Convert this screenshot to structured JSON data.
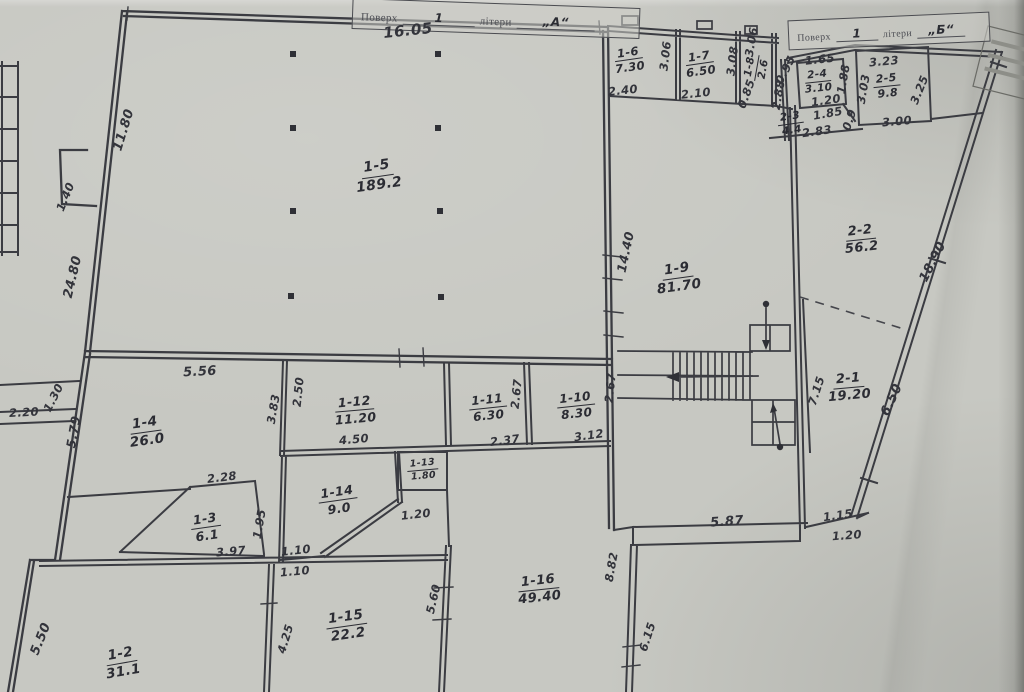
{
  "title_blocks": {
    "a": {
      "prefix": "Поверх",
      "floor": "1",
      "middle": "літери",
      "letter": "„А“"
    },
    "b": {
      "prefix": "Поверх",
      "floor": "1",
      "middle": "літери",
      "letter": "„Б“"
    }
  },
  "rooms": [
    {
      "id": "1-5",
      "a": "189.2",
      "x": 378,
      "y": 176,
      "r": -8,
      "fs": 14
    },
    {
      "id": "1-6",
      "a": "7.30",
      "x": 629,
      "y": 60,
      "r": -8,
      "fs": 11.5
    },
    {
      "id": "1-7",
      "a": "6.50",
      "x": 700,
      "y": 64,
      "r": -8,
      "fs": 11.5
    },
    {
      "id": "1-8",
      "a": "2.6",
      "x": 757,
      "y": 68,
      "r": -80,
      "fs": 10.5
    },
    {
      "id": "2-4",
      "a": "3.10",
      "x": 818,
      "y": 82,
      "r": -6,
      "fs": 10.5
    },
    {
      "id": "2-5",
      "a": "9.8",
      "x": 887,
      "y": 86,
      "r": -6,
      "fs": 11
    },
    {
      "id": "2-3",
      "a": "4.4",
      "x": 791,
      "y": 124,
      "r": -8,
      "fs": 10.5
    },
    {
      "id": "2-2",
      "a": "56.2",
      "x": 861,
      "y": 240,
      "r": -6,
      "fs": 13
    },
    {
      "id": "1-9",
      "a": "81.70",
      "x": 678,
      "y": 278,
      "r": -8,
      "fs": 13.5
    },
    {
      "id": "2-1",
      "a": "19.20",
      "x": 849,
      "y": 388,
      "r": -5,
      "fs": 13
    },
    {
      "id": "1-4",
      "a": "26.0",
      "x": 146,
      "y": 432,
      "r": -8,
      "fs": 13.5
    },
    {
      "id": "1-12",
      "a": "11.20",
      "x": 355,
      "y": 410,
      "r": -5,
      "fs": 12.5
    },
    {
      "id": "1-11",
      "a": "6.30",
      "x": 488,
      "y": 408,
      "r": -6,
      "fs": 12
    },
    {
      "id": "1-10",
      "a": "8.30",
      "x": 576,
      "y": 406,
      "r": -6,
      "fs": 12
    },
    {
      "id": "1-13",
      "a": "1.80",
      "x": 423,
      "y": 470,
      "r": -5,
      "fs": 9.5
    },
    {
      "id": "1-14",
      "a": "9.0",
      "x": 338,
      "y": 500,
      "r": -8,
      "fs": 12.5
    },
    {
      "id": "1-3",
      "a": "6.1",
      "x": 206,
      "y": 527,
      "r": -8,
      "fs": 12.5
    },
    {
      "id": "1-15",
      "a": "22.2",
      "x": 347,
      "y": 626,
      "r": -8,
      "fs": 13.5
    },
    {
      "id": "1-16",
      "a": "49.40",
      "x": 539,
      "y": 590,
      "r": -6,
      "fs": 13
    },
    {
      "id": "1-2",
      "a": "31.1",
      "x": 122,
      "y": 663,
      "r": -10,
      "fs": 13.5
    }
  ],
  "dims": [
    {
      "t": "16.05",
      "x": 408,
      "y": 31,
      "r": -6,
      "fs": 15
    },
    {
      "t": "11.80",
      "x": 124,
      "y": 130,
      "r": -73,
      "fs": 13
    },
    {
      "t": "1.40",
      "x": 66,
      "y": 197,
      "r": -68
    },
    {
      "t": "24.80",
      "x": 73,
      "y": 277,
      "r": -77,
      "fs": 13
    },
    {
      "t": "2.40",
      "x": 623,
      "y": 91,
      "r": -6
    },
    {
      "t": "3.06",
      "x": 666,
      "y": 56,
      "r": -83
    },
    {
      "t": "2.10",
      "x": 696,
      "y": 94,
      "r": -6
    },
    {
      "t": "3.08",
      "x": 733,
      "y": 61,
      "r": -83
    },
    {
      "t": "3.06",
      "x": 752,
      "y": 42,
      "r": -80
    },
    {
      "t": "0.85",
      "x": 747,
      "y": 94,
      "r": -70
    },
    {
      "t": "0.95",
      "x": 786,
      "y": 70,
      "r": -63
    },
    {
      "t": "2.88",
      "x": 779,
      "y": 95,
      "r": -80
    },
    {
      "t": "1.65",
      "x": 820,
      "y": 60,
      "r": -6
    },
    {
      "t": "1.88",
      "x": 844,
      "y": 79,
      "r": -80
    },
    {
      "t": "1.20",
      "x": 826,
      "y": 101,
      "r": -8
    },
    {
      "t": "1.85",
      "x": 828,
      "y": 114,
      "r": -10
    },
    {
      "t": "0.9",
      "x": 850,
      "y": 120,
      "r": -72
    },
    {
      "t": "2.83",
      "x": 817,
      "y": 132,
      "r": -8
    },
    {
      "t": "3.23",
      "x": 884,
      "y": 62,
      "r": -5
    },
    {
      "t": "3.03",
      "x": 864,
      "y": 89,
      "r": -80
    },
    {
      "t": "3.25",
      "x": 920,
      "y": 90,
      "r": -68
    },
    {
      "t": "3.00",
      "x": 897,
      "y": 122,
      "r": -5
    },
    {
      "t": "18.90",
      "x": 933,
      "y": 262,
      "r": -63,
      "fs": 13
    },
    {
      "t": "14.40",
      "x": 626,
      "y": 252,
      "r": -78,
      "fs": 12.5
    },
    {
      "t": "7.15",
      "x": 817,
      "y": 391,
      "r": -72
    },
    {
      "t": "6.50",
      "x": 892,
      "y": 400,
      "r": -65,
      "fs": 13
    },
    {
      "t": "5.56",
      "x": 200,
      "y": 372,
      "r": -3,
      "fs": 13
    },
    {
      "t": "3.83",
      "x": 274,
      "y": 409,
      "r": -80
    },
    {
      "t": "2.50",
      "x": 299,
      "y": 392,
      "r": -84
    },
    {
      "t": "4.50",
      "x": 354,
      "y": 440,
      "r": -5
    },
    {
      "t": "2.67",
      "x": 517,
      "y": 394,
      "r": -84
    },
    {
      "t": "2.37",
      "x": 505,
      "y": 441,
      "r": -7
    },
    {
      "t": "2.67",
      "x": 611,
      "y": 388,
      "r": -84
    },
    {
      "t": "3.12",
      "x": 589,
      "y": 436,
      "r": -8
    },
    {
      "t": "2.20",
      "x": 24,
      "y": 413,
      "r": -3
    },
    {
      "t": "1.30",
      "x": 54,
      "y": 398,
      "r": -63
    },
    {
      "t": "5.79",
      "x": 74,
      "y": 432,
      "r": -80,
      "fs": 12.5
    },
    {
      "t": "2.28",
      "x": 222,
      "y": 478,
      "r": -7
    },
    {
      "t": "1.95",
      "x": 260,
      "y": 524,
      "r": -80
    },
    {
      "t": "3.97",
      "x": 231,
      "y": 552,
      "r": -5
    },
    {
      "t": "1.10",
      "x": 296,
      "y": 551,
      "r": -6
    },
    {
      "t": "1.10",
      "x": 295,
      "y": 572,
      "r": -5
    },
    {
      "t": "1.20",
      "x": 416,
      "y": 515,
      "r": -6
    },
    {
      "t": "5.87",
      "x": 727,
      "y": 522,
      "r": -4,
      "fs": 13
    },
    {
      "t": "1.15",
      "x": 838,
      "y": 516,
      "r": -8
    },
    {
      "t": "1.20",
      "x": 847,
      "y": 536,
      "r": -4
    },
    {
      "t": "8.82",
      "x": 612,
      "y": 567,
      "r": -80
    },
    {
      "t": "6.15",
      "x": 648,
      "y": 637,
      "r": -72
    },
    {
      "t": "5.60",
      "x": 434,
      "y": 599,
      "r": -77
    },
    {
      "t": "4.25",
      "x": 286,
      "y": 639,
      "r": -73
    },
    {
      "t": "5.50",
      "x": 41,
      "y": 639,
      "r": -68,
      "fs": 13
    }
  ]
}
